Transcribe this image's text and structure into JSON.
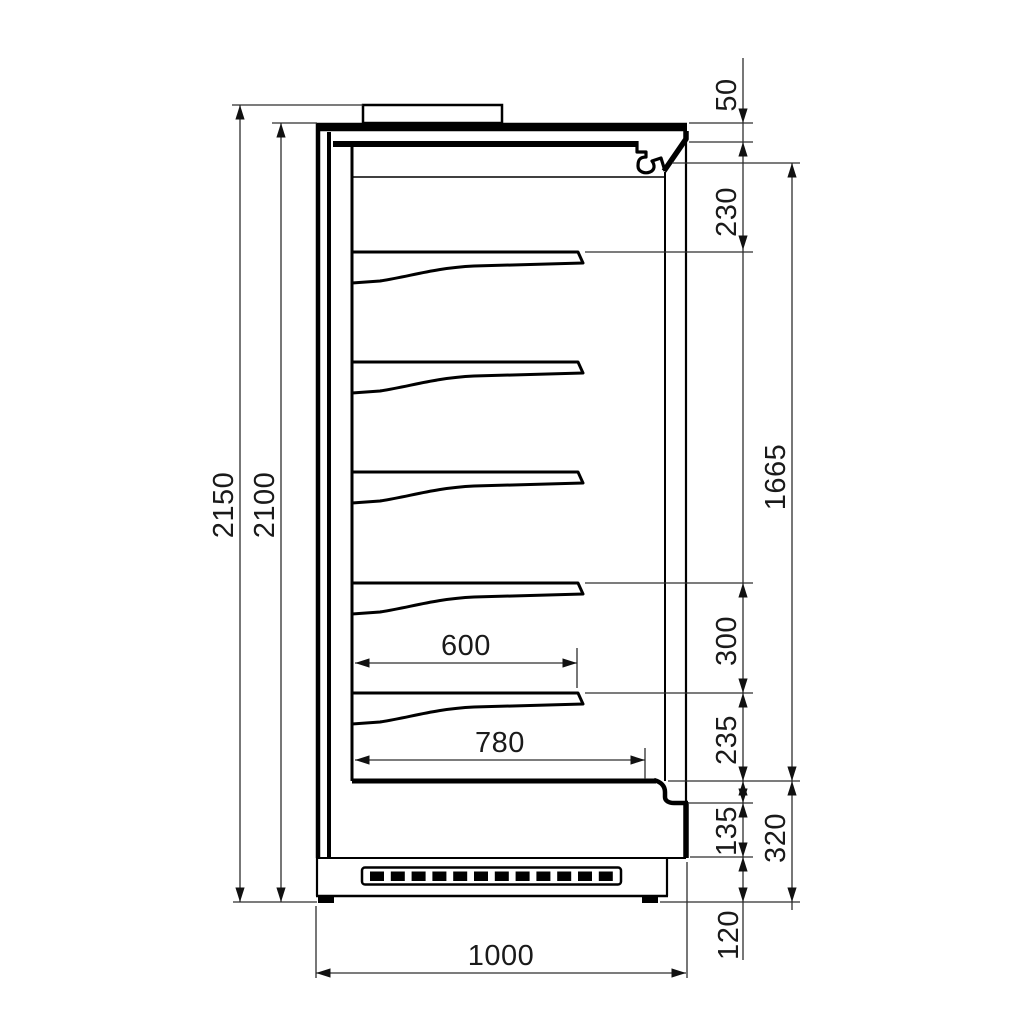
{
  "drawing": {
    "description": "technical side-section drawing of a multideck refrigerated display cabinet with dimension chains",
    "units": "mm",
    "colors": {
      "geometry_line": "#000000",
      "dimension_line": "#2e2e2e",
      "background": "#ffffff"
    },
    "dims": {
      "overall_height": "2150",
      "body_height": "2100",
      "top_gap": "50",
      "canopy_to_top_shelf": "230",
      "display_opening": "1665",
      "shelf_spacing": "300",
      "bottom_shelf_to_deck": "235",
      "front_panel_height": "135",
      "base_section_height": "320",
      "plinth_height": "120",
      "shelf_depth": "600",
      "deck_depth": "780",
      "overall_depth": "1000"
    }
  }
}
